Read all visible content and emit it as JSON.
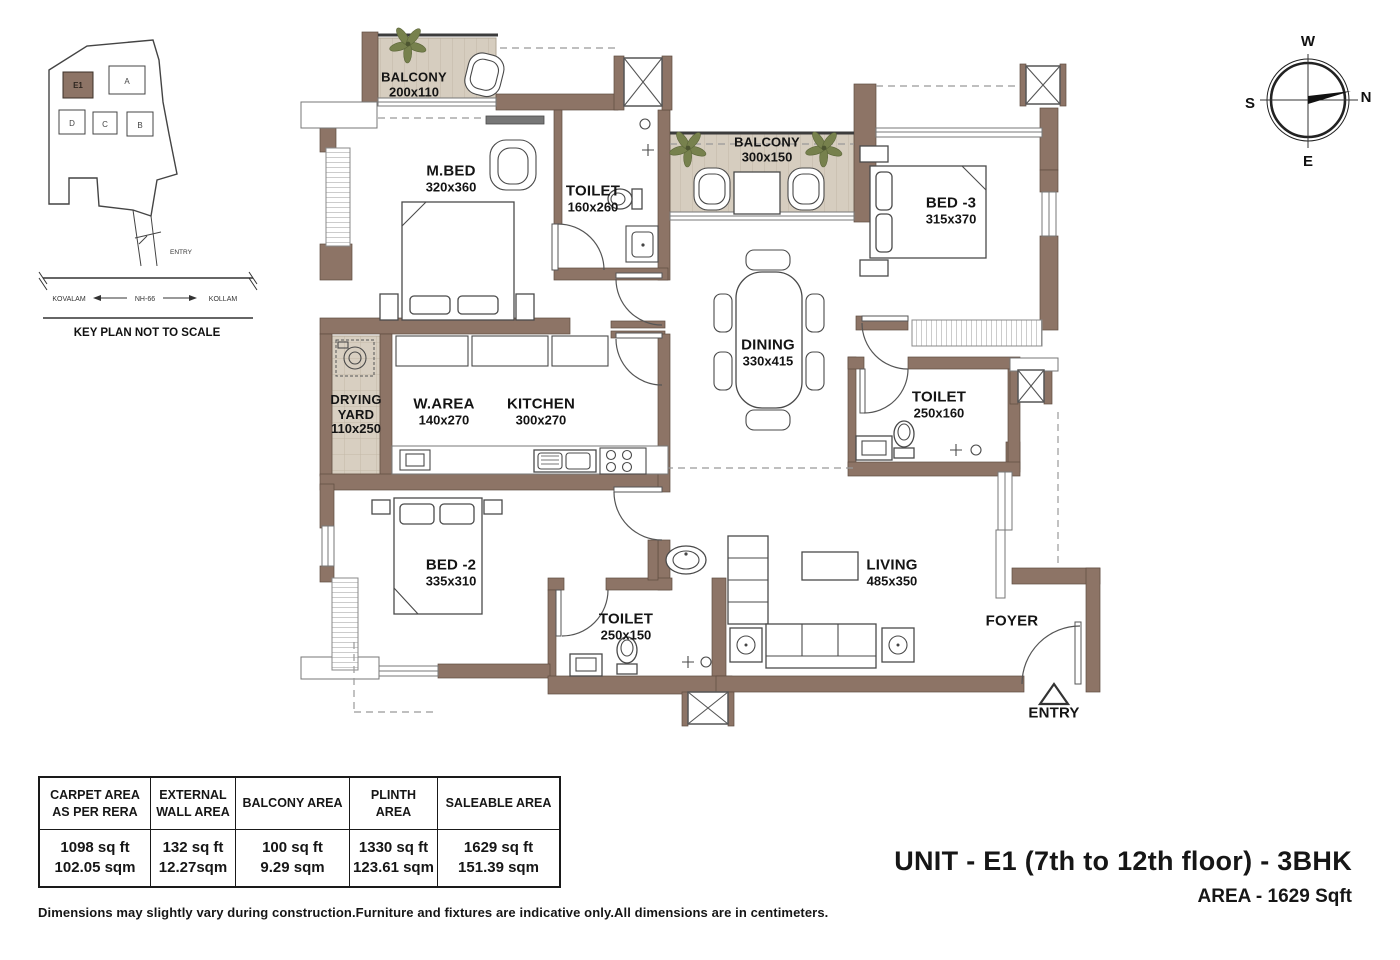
{
  "header": {
    "unit_title": "UNIT - E1 (7th to 12th floor) - 3BHK",
    "area_line": "AREA - 1629 Sqft"
  },
  "disclaimer": "Dimensions may slightly vary during construction.Furniture and fixtures are indicative only.All dimensions are in centimeters.",
  "key_plan": {
    "caption": "KEY PLAN NOT TO SCALE",
    "entry_label": "ENTRY",
    "road_left": "KOVALAM",
    "road_center": "NH-66",
    "road_right": "KOLLAM",
    "buildings": {
      "e1": "E1",
      "a": "A",
      "b": "B",
      "c": "C",
      "d": "D"
    }
  },
  "compass": {
    "top": "W",
    "right": "N",
    "bottom": "E",
    "left": "S"
  },
  "rooms": {
    "balcony_top": {
      "name": "BALCONY",
      "dims": "200x110"
    },
    "mbed": {
      "name": "M.BED",
      "dims": "320x360"
    },
    "toilet_mbed": {
      "name": "TOILET",
      "dims": "160x260"
    },
    "balcony_mid": {
      "name": "BALCONY",
      "dims": "300x150"
    },
    "bed3": {
      "name": "BED -3",
      "dims": "315x370"
    },
    "dining": {
      "name": "DINING",
      "dims": "330x415"
    },
    "toilet_bed3": {
      "name": "TOILET",
      "dims": "250x160"
    },
    "drying_yard": {
      "name": "DRYING YARD",
      "dims": "110x250"
    },
    "warea": {
      "name": "W.AREA",
      "dims": "140x270"
    },
    "kitchen": {
      "name": "KITCHEN",
      "dims": "300x270"
    },
    "bed2": {
      "name": "BED -2",
      "dims": "335x310"
    },
    "toilet_common": {
      "name": "TOILET",
      "dims": "250x150"
    },
    "living": {
      "name": "LIVING",
      "dims": "485x350"
    },
    "foyer": {
      "name": "FOYER"
    },
    "entry": {
      "name": "ENTRY"
    }
  },
  "area_table": {
    "cols": [
      {
        "header": "CARPET AREA\nAS PER RERA",
        "value": "1098 sq ft\n102.05 sqm"
      },
      {
        "header": "EXTERNAL\nWALL AREA",
        "value": "132 sq ft\n12.27sqm"
      },
      {
        "header": "BALCONY AREA",
        "value": "100 sq ft\n9.29 sqm"
      },
      {
        "header": "PLINTH AREA",
        "value": "1330 sq ft\n123.61 sqm"
      },
      {
        "header": "SALEABLE AREA",
        "value": "1629 sq ft\n151.39 sqm"
      }
    ]
  },
  "colors": {
    "wall": "#8d7466",
    "balcony_floor": "#d6cdbf",
    "plant_green": "#77814d"
  }
}
